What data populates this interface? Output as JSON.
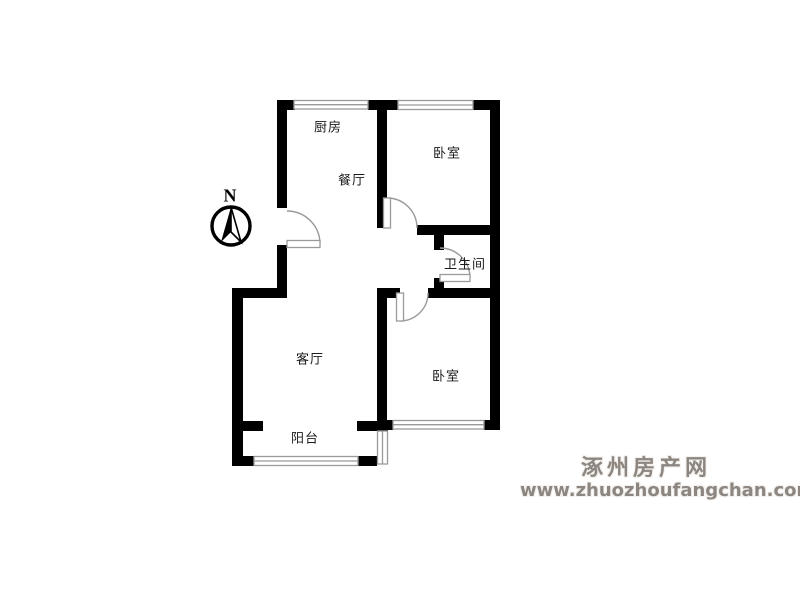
{
  "plan": {
    "type": "apartment-floorplan",
    "rooms": [
      {
        "id": "kitchen",
        "label": "厨房"
      },
      {
        "id": "dining",
        "label": "餐厅"
      },
      {
        "id": "bedroom1",
        "label": "卧室"
      },
      {
        "id": "bathroom",
        "label": "卫生间"
      },
      {
        "id": "living",
        "label": "客厅"
      },
      {
        "id": "balcony",
        "label": "阳台"
      },
      {
        "id": "bedroom2",
        "label": "卧室"
      }
    ],
    "compass": {
      "label": "N"
    }
  },
  "watermark": {
    "site_name": "涿州房产网",
    "site_url": "www.zhuozhoufangchan.com",
    "color": "#8d8680"
  },
  "colors": {
    "wall": "#000000",
    "window_outline": "#9a9a9a",
    "door_arc": "#9a9a9a",
    "background": "#ffffff"
  }
}
